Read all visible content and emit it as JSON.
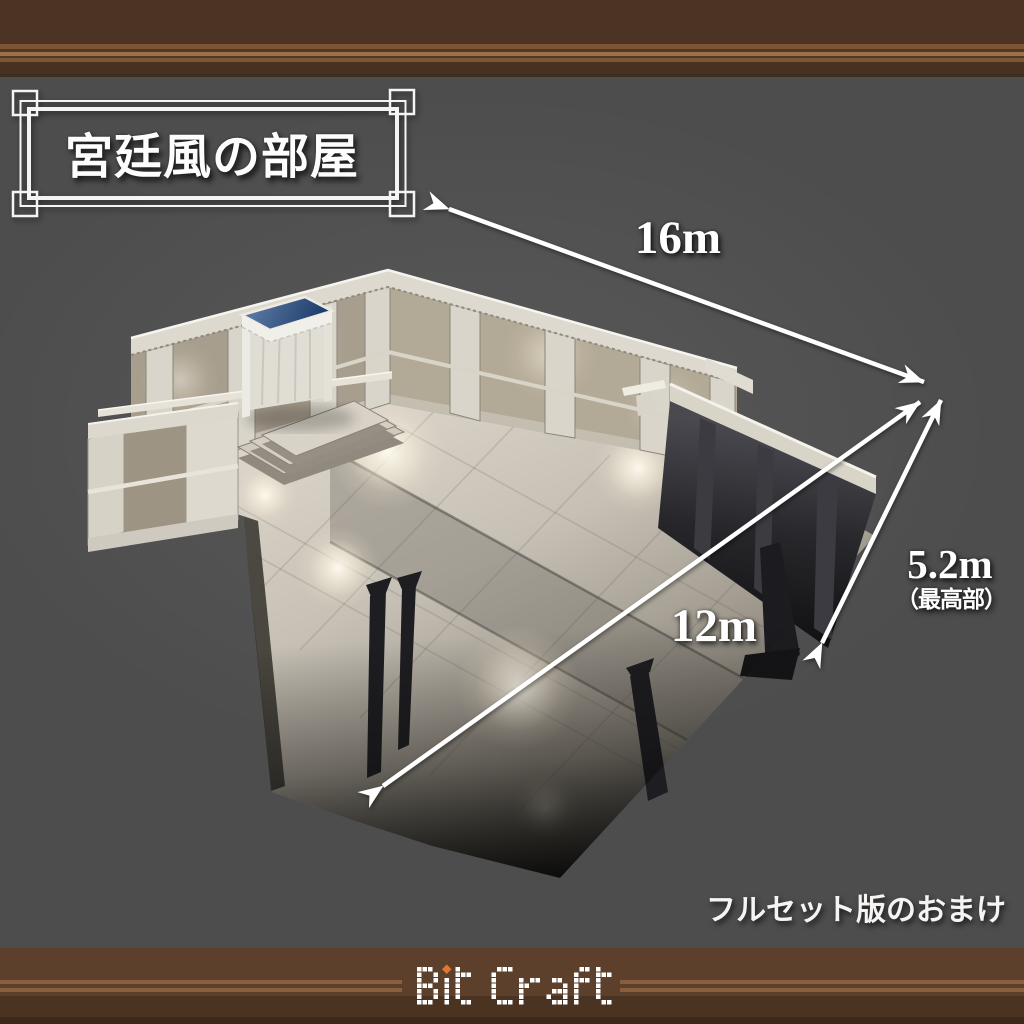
{
  "title": {
    "text": "宮廷風の部屋"
  },
  "dimensions": {
    "width": {
      "label": "16m"
    },
    "depth": {
      "label": "12m"
    },
    "height": {
      "label": "5.2m",
      "qualifier": "（最高部）"
    }
  },
  "note": {
    "text": "フルセット版のおまけ"
  },
  "logo": {
    "text": "Bit Craft",
    "text_color": "#ffffff",
    "accent_color": "#e2762e"
  },
  "colors": {
    "background": "#4d4d4e",
    "band_dark_brown": "#4b3424",
    "band_mid_brown": "#7d5637",
    "band_light_brown": "#9c7048",
    "arrow": "#ffffff",
    "frame": "#f4f4f2",
    "canopy_blue": "#2c4a7c"
  }
}
